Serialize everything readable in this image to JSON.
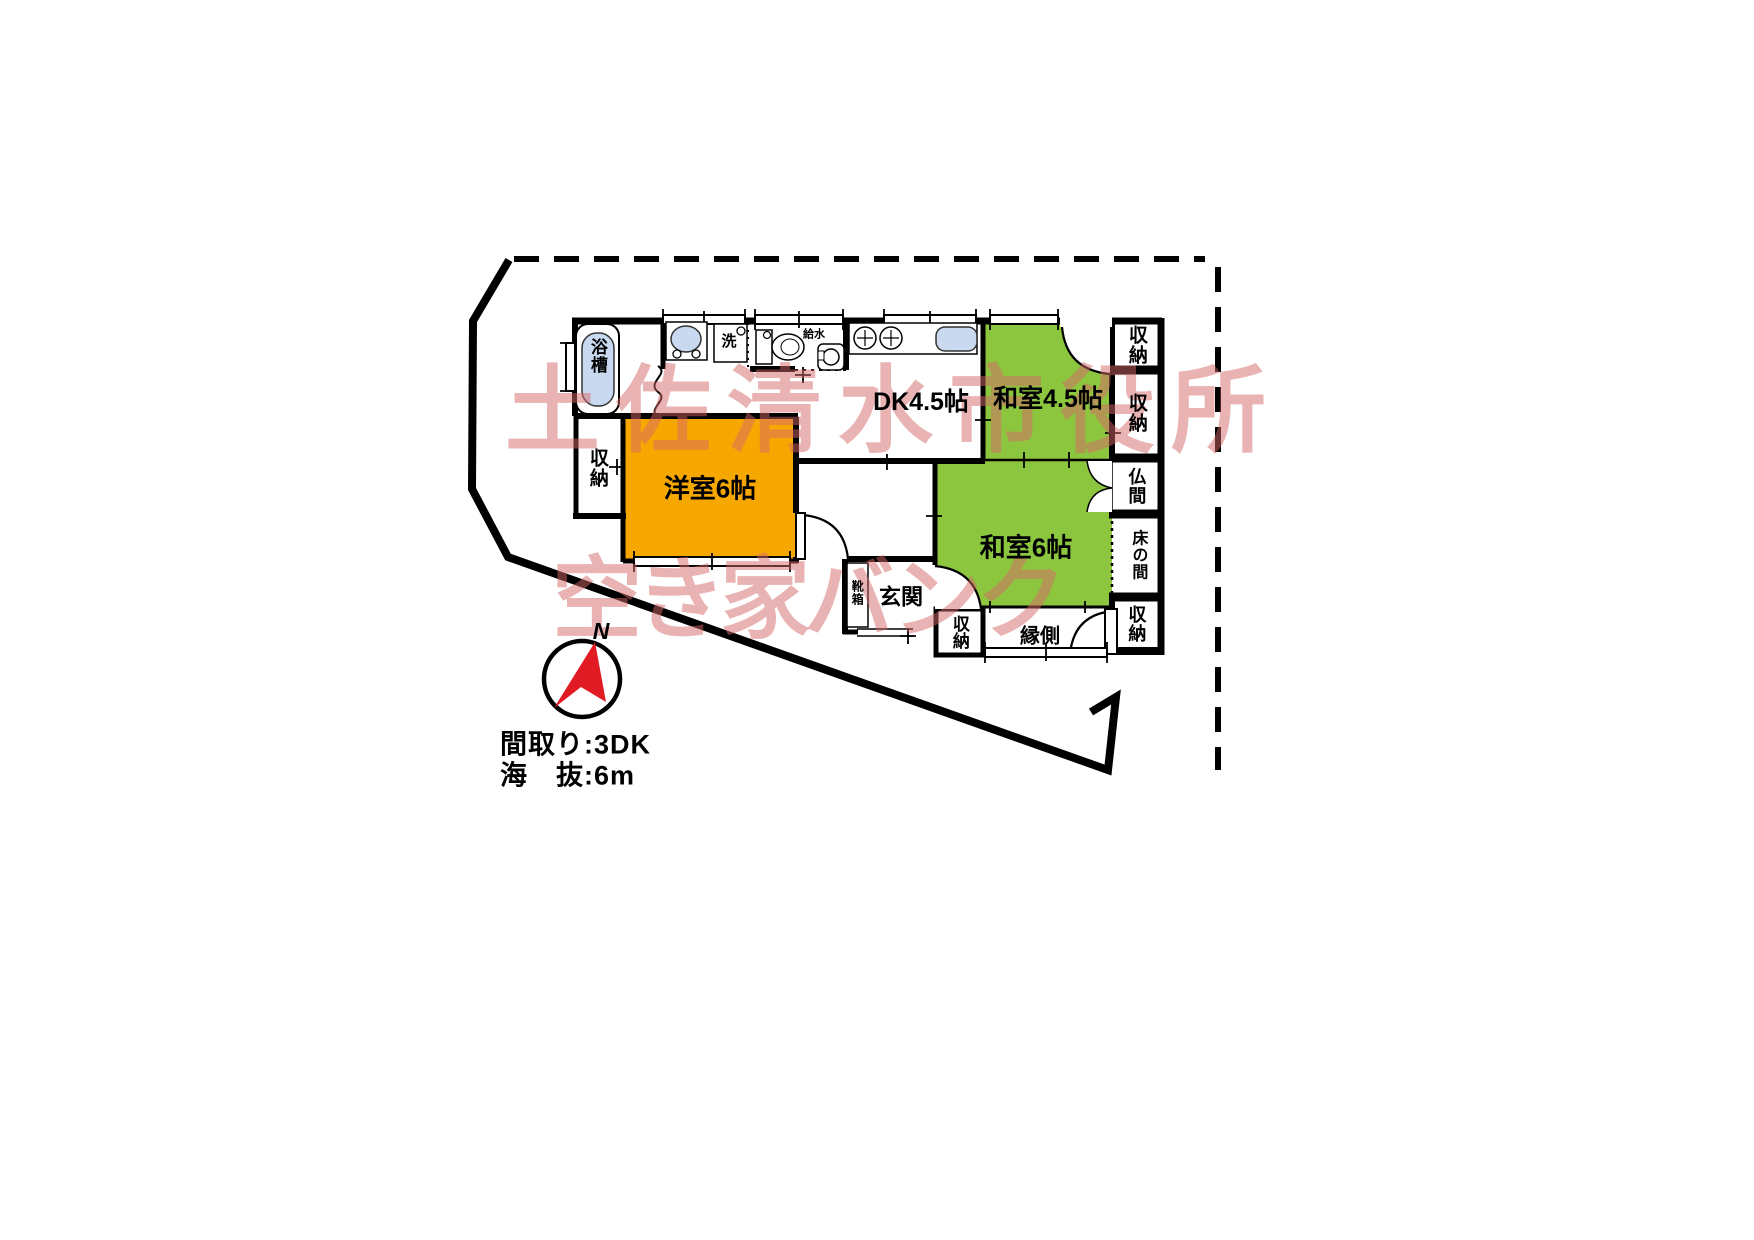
{
  "watermark": {
    "line1": "土佐清水市役所",
    "line2": "空き家バンク",
    "color": "rgba(214,104,104,0.5)"
  },
  "plan": {
    "rooms": {
      "western_room": "洋室6帖",
      "dining_kitchen": "DK4.5帖",
      "japanese_room_45": "和室4.5帖",
      "japanese_room_6": "和室6帖",
      "entrance": "玄関",
      "veranda": "縁側",
      "butsuma": "仏間",
      "tokonoma": "床の間",
      "storage": "収納",
      "shoe_box": "靴箱",
      "bathtub": "浴槽",
      "wash": "洗",
      "water_supply": "給水"
    },
    "info": {
      "layout": "間取り:3DK",
      "elevation": "海　抜:6m"
    },
    "compass_label": "N",
    "colors": {
      "tatami_green": "#8cc63f",
      "western_orange": "#f7a800",
      "fixture_blue": "#c9daf0",
      "arrow_red": "#e01b24"
    }
  }
}
